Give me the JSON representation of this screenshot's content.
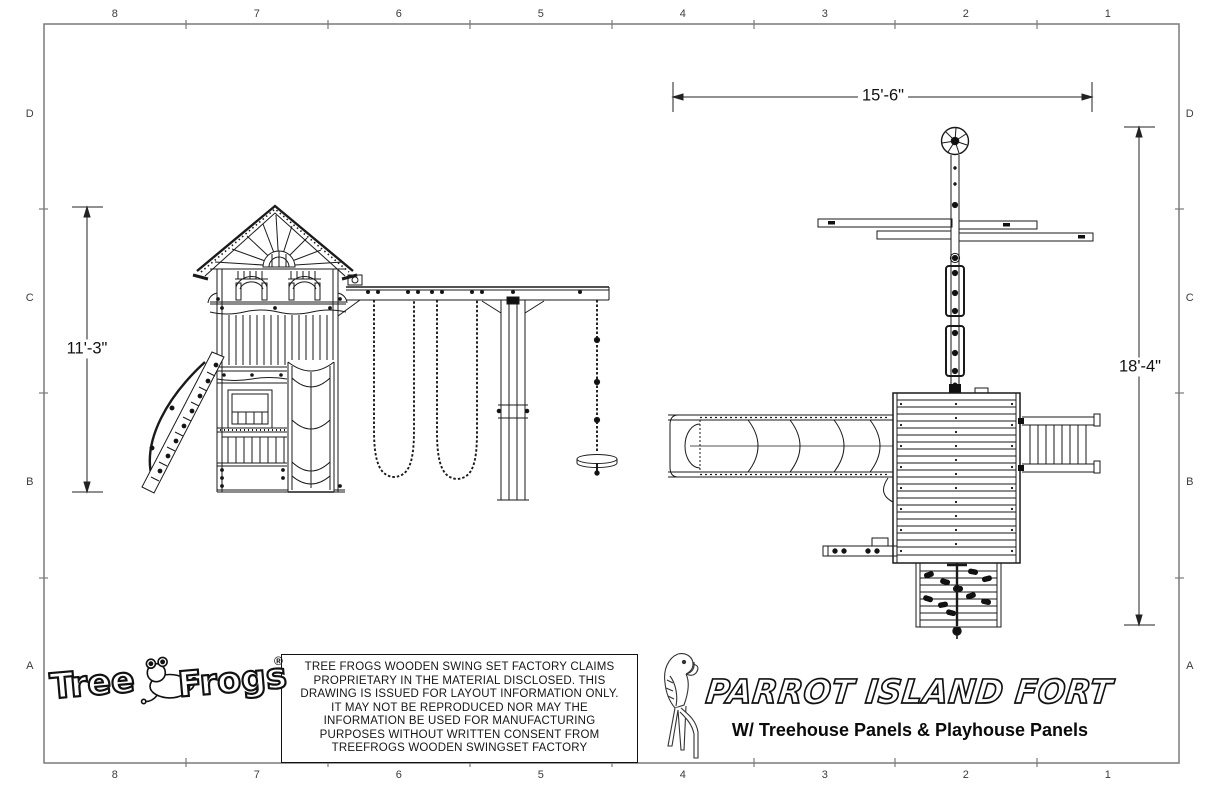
{
  "sheet": {
    "grid": {
      "columns": [
        "8",
        "7",
        "6",
        "5",
        "4",
        "3",
        "2",
        "1"
      ],
      "rows": [
        "D",
        "C",
        "B",
        "A"
      ]
    },
    "dimensions": {
      "elevation_height": "11'-3\"",
      "plan_width": "15'-6\"",
      "plan_depth": "18'-4\""
    },
    "disclaimer": {
      "lines": [
        "TREE FROGS WOODEN SWING SET FACTORY CLAIMS",
        "PROPRIETARY IN THE MATERIAL DISCLOSED. THIS",
        "DRAWING IS ISSUED FOR LAYOUT INFORMATION ONLY.",
        "IT MAY NOT BE REPRODUCED NOR MAY THE",
        "INFORMATION BE USED FOR MANUFACTURING",
        "PURPOSES WITHOUT WRITTEN CONSENT FROM",
        "TREEFROGS WOODEN SWINGSET FACTORY"
      ]
    },
    "logo": {
      "word1": "Tree",
      "word2": "Frogs",
      "registered": "®"
    },
    "title_block": {
      "title": "PARROT ISLAND FORT",
      "subtitle": "W/ Treehouse Panels & Playhouse Panels"
    },
    "icons": {
      "parrot": "parrot-outline-icon",
      "frog": "tree-frog-icon",
      "ships_wheel": "ships-wheel-icon"
    },
    "colors": {
      "line": "#1a1a1a",
      "border": "#7a7a7a",
      "background": "#ffffff"
    }
  }
}
